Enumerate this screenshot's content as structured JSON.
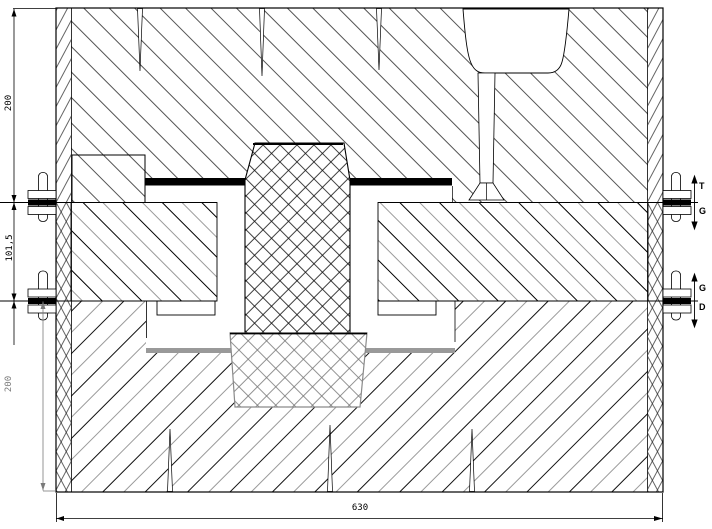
{
  "drawing": {
    "dim_left_top": "200",
    "dim_left_middle": "101,5",
    "dim_left_bottom": "200",
    "dim_bottom_width": "630",
    "label_top_upper": "T",
    "label_top_lower": "G",
    "label_bottom_upper": "G",
    "label_bottom_lower": "D",
    "colors": {
      "line_black": "#000000",
      "line_gray": "#888888",
      "seal_band_black": "#000000",
      "support_band_gray": "#999999",
      "background": "#ffffff"
    }
  }
}
